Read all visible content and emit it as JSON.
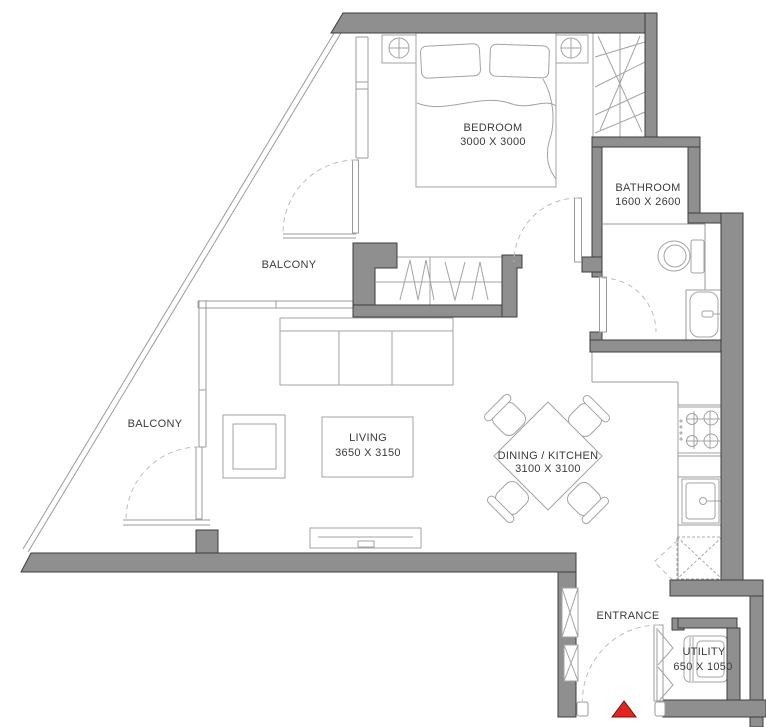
{
  "plan": {
    "title": "Apartment floor plan",
    "rooms": [
      {
        "id": "bedroom",
        "name": "BEDROOM",
        "dims": "3000 X 3000"
      },
      {
        "id": "bathroom",
        "name": "BATHROOM",
        "dims": "1600 X 2600"
      },
      {
        "id": "balcony-upper",
        "name": "BALCONY",
        "dims": ""
      },
      {
        "id": "balcony-lower",
        "name": "BALCONY",
        "dims": ""
      },
      {
        "id": "living",
        "name": "LIVING",
        "dims": "3650 X 3150"
      },
      {
        "id": "dining-kitchen",
        "name": "DINING / KITCHEN",
        "dims": "3100 X 3100"
      },
      {
        "id": "entrance",
        "name": "ENTRANCE",
        "dims": ""
      },
      {
        "id": "utility",
        "name": "UTILITY",
        "dims": "650 X 1050"
      }
    ],
    "colors": {
      "wall": "#8f8f8f",
      "wall_outline": "#3d3d3d",
      "furniture_line": "#a3a3a3",
      "entrance_marker": "#e02420",
      "entrance_marker_outline": "#7a120c",
      "text": "#3b3b3b",
      "background": "#ffffff"
    },
    "icons": [
      "bed-icon",
      "pillow-icon",
      "nightstand-lamp-icon",
      "wardrobe-icon",
      "closet-icon",
      "sofa-icon",
      "armchair-icon",
      "rug-icon",
      "tv-console-icon",
      "dining-table-icon",
      "chair-icon",
      "stove-icon",
      "kitchen-sink-icon",
      "dishwasher-icon",
      "washing-machine-icon",
      "toilet-icon",
      "vanity-sink-icon",
      "door-swing-icon",
      "bifold-door-icon",
      "shaft-icon",
      "entrance-marker-icon"
    ]
  }
}
